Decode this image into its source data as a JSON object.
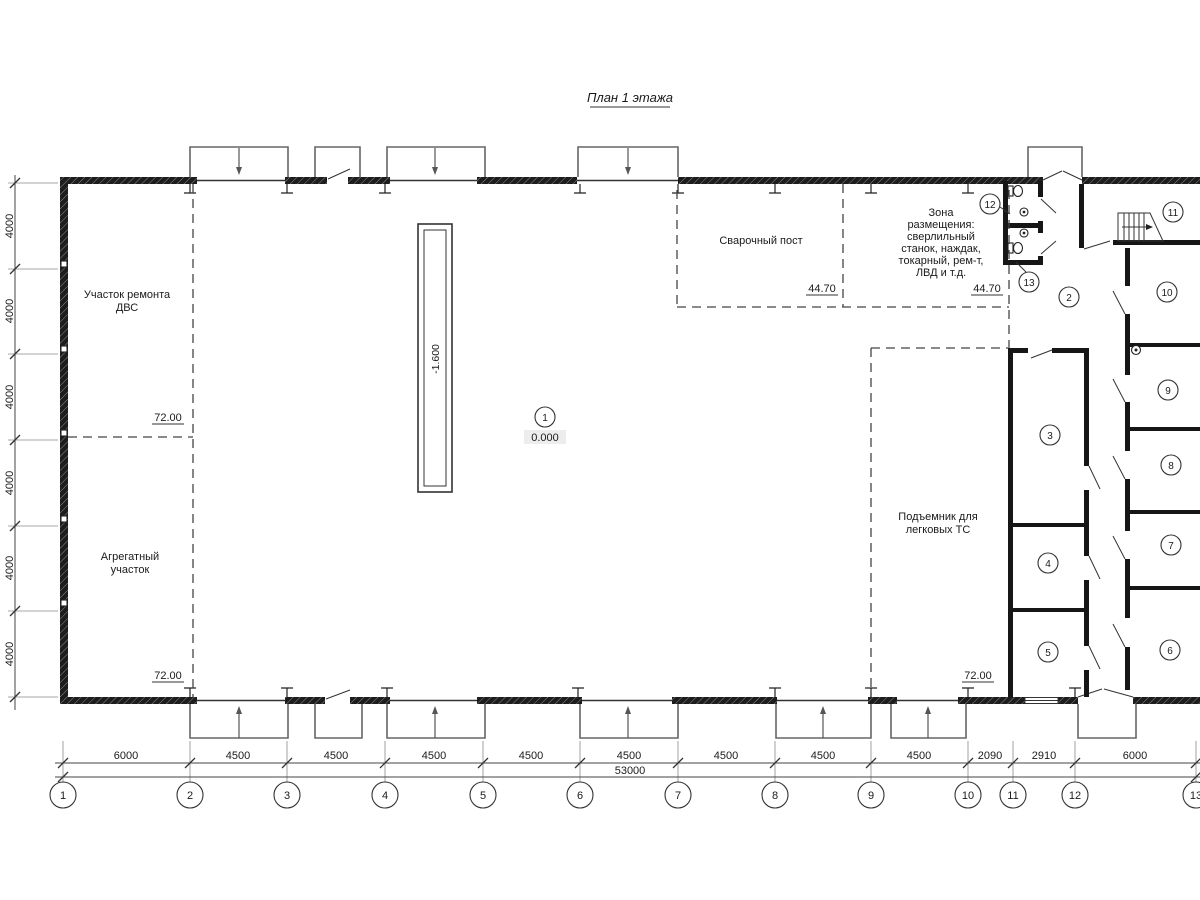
{
  "title": "План 1 этажа",
  "rooms": {
    "dvs": {
      "line1": "Участок ремонта",
      "line2": "ДВС",
      "elevation": "72.00"
    },
    "agregat": {
      "line1": "Агрегатный",
      "line2": "участок",
      "elevation": "72.00"
    },
    "svarka": {
      "label": "Сварочный пост",
      "elevation": "44.70"
    },
    "zona": {
      "lines": [
        "Зона",
        "размещения:",
        "сверлильный",
        "станок, наждак,",
        "токарный, рем-т,",
        "ЛВД и т.д."
      ],
      "elevation": "44.70"
    },
    "podyemnik": {
      "line1": "Подъемник для",
      "line2": "легковых ТС",
      "elevation": "72.00"
    },
    "hall": {
      "elevation": "0.000"
    },
    "pit": {
      "elevation": "-1.600"
    }
  },
  "room_numbers": [
    "1",
    "2",
    "3",
    "4",
    "5",
    "6",
    "7",
    "8",
    "9",
    "10",
    "11",
    "12",
    "13"
  ],
  "grid": {
    "bubbles": [
      "1",
      "2",
      "3",
      "4",
      "5",
      "6",
      "7",
      "8",
      "9",
      "10",
      "11",
      "12",
      "13"
    ],
    "bottom_dims": [
      "6000",
      "4500",
      "4500",
      "4500",
      "4500",
      "4500",
      "4500",
      "4500",
      "4500",
      "2090",
      "2910",
      "6000"
    ],
    "total_dim": "53000",
    "left_dims": [
      "4000",
      "4000",
      "4000",
      "4000",
      "4000",
      "4000"
    ]
  },
  "colors": {
    "line": "#333333",
    "wall": "#161616",
    "background": "#ffffff"
  }
}
